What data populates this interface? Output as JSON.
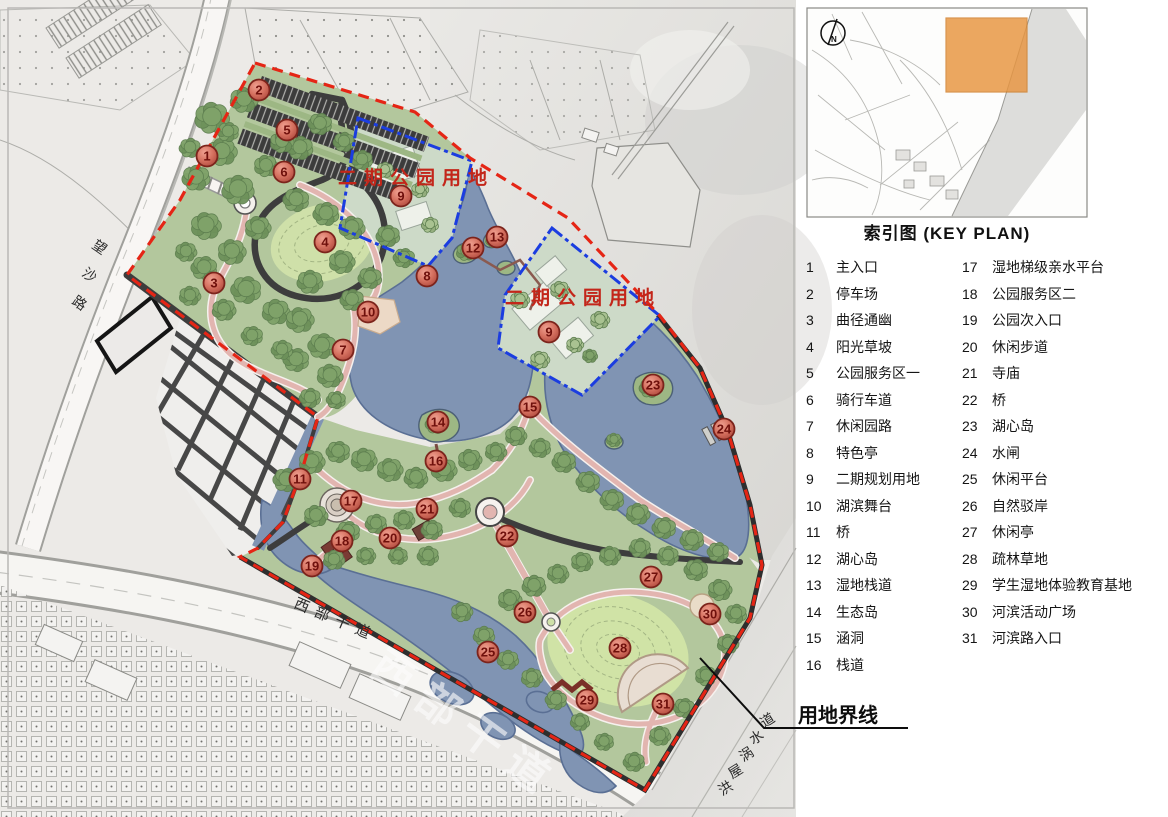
{
  "colors": {
    "boundary_red": "#e52515",
    "phase_blue": "#1b3de0",
    "marker_ring": "#7c241c",
    "marker_text": "#6f100c",
    "keyplan_highlight": "#e8953f",
    "lake": "#8094b3",
    "park_green": "#b3c79d"
  },
  "map": {
    "markers": [
      {
        "n": "1",
        "x": 207,
        "y": 156
      },
      {
        "n": "2",
        "x": 259,
        "y": 90
      },
      {
        "n": "3",
        "x": 214,
        "y": 283
      },
      {
        "n": "4",
        "x": 325,
        "y": 242
      },
      {
        "n": "5",
        "x": 287,
        "y": 130
      },
      {
        "n": "6",
        "x": 284,
        "y": 172
      },
      {
        "n": "7",
        "x": 343,
        "y": 350
      },
      {
        "n": "8",
        "x": 427,
        "y": 276
      },
      {
        "n": "9",
        "x": 401,
        "y": 196
      },
      {
        "n": "9",
        "x": 549,
        "y": 332
      },
      {
        "n": "10",
        "x": 368,
        "y": 312
      },
      {
        "n": "11",
        "x": 300,
        "y": 479
      },
      {
        "n": "12",
        "x": 473,
        "y": 248
      },
      {
        "n": "13",
        "x": 497,
        "y": 237
      },
      {
        "n": "14",
        "x": 438,
        "y": 422
      },
      {
        "n": "15",
        "x": 530,
        "y": 407
      },
      {
        "n": "16",
        "x": 436,
        "y": 461
      },
      {
        "n": "17",
        "x": 351,
        "y": 501
      },
      {
        "n": "18",
        "x": 342,
        "y": 541
      },
      {
        "n": "19",
        "x": 312,
        "y": 566
      },
      {
        "n": "20",
        "x": 390,
        "y": 538
      },
      {
        "n": "21",
        "x": 427,
        "y": 509
      },
      {
        "n": "22",
        "x": 507,
        "y": 536
      },
      {
        "n": "23",
        "x": 653,
        "y": 385
      },
      {
        "n": "24",
        "x": 724,
        "y": 429
      },
      {
        "n": "25",
        "x": 488,
        "y": 652
      },
      {
        "n": "26",
        "x": 525,
        "y": 612
      },
      {
        "n": "27",
        "x": 651,
        "y": 577
      },
      {
        "n": "28",
        "x": 620,
        "y": 648
      },
      {
        "n": "29",
        "x": 587,
        "y": 700
      },
      {
        "n": "30",
        "x": 710,
        "y": 614
      },
      {
        "n": "31",
        "x": 663,
        "y": 704
      }
    ],
    "area_labels": [
      {
        "text": "二期公园用地",
        "x": 338,
        "y": 184,
        "size": 19,
        "ls": 7
      },
      {
        "text": "二期公园用地",
        "x": 505,
        "y": 304,
        "size": 19,
        "ls": 7
      }
    ],
    "road_labels": [
      {
        "text": "望沙路",
        "char_x": [
          91,
          81,
          71
        ],
        "char_y": [
          247,
          275,
          303
        ],
        "rotate": 35,
        "size": 14,
        "style": "dark"
      },
      {
        "text": "西部干道",
        "x": 293,
        "y": 607,
        "rotate": 23,
        "size": 15,
        "ls": 7,
        "style": "dark"
      },
      {
        "text": "西部干道",
        "x": 368,
        "y": 672,
        "rotate": 36,
        "size": 42,
        "ls": 13,
        "style": "watermark"
      },
      {
        "text": "洪屋涡水道",
        "char_x": [
          722,
          732,
          743,
          753,
          764
        ],
        "char_y": [
          796,
          779,
          762,
          745,
          728
        ],
        "rotate": -32,
        "size": 14,
        "style": "dark"
      }
    ],
    "boundary_label": {
      "text": "用地界线"
    }
  },
  "key_plan": {
    "caption": "索引图 (KEY  PLAN)",
    "north_label": "N"
  },
  "legend": {
    "col1": [
      {
        "num": "1",
        "label": "主入口"
      },
      {
        "num": "2",
        "label": "停车场"
      },
      {
        "num": "3",
        "label": "曲径通幽"
      },
      {
        "num": "4",
        "label": "阳光草坡"
      },
      {
        "num": "5",
        "label": "公园服务区一"
      },
      {
        "num": "6",
        "label": "骑行车道"
      },
      {
        "num": "7",
        "label": "休闲园路"
      },
      {
        "num": "8",
        "label": "特色亭"
      },
      {
        "num": "9",
        "label": "二期规划用地"
      },
      {
        "num": "10",
        "label": "湖滨舞台"
      },
      {
        "num": "11",
        "label": "桥"
      },
      {
        "num": "12",
        "label": "湖心岛"
      },
      {
        "num": "13",
        "label": "湿地栈道"
      },
      {
        "num": "14",
        "label": "生态岛"
      },
      {
        "num": "15",
        "label": "涵洞"
      },
      {
        "num": "16",
        "label": "栈道"
      }
    ],
    "col2": [
      {
        "num": "17",
        "label": "湿地梯级亲水平台"
      },
      {
        "num": "18",
        "label": "公园服务区二"
      },
      {
        "num": "19",
        "label": "公园次入口"
      },
      {
        "num": "20",
        "label": "休闲步道"
      },
      {
        "num": "21",
        "label": "寺庙"
      },
      {
        "num": "22",
        "label": "桥"
      },
      {
        "num": "23",
        "label": "湖心岛"
      },
      {
        "num": "24",
        "label": "水闸"
      },
      {
        "num": "25",
        "label": "休闲平台"
      },
      {
        "num": "26",
        "label": "自然驳岸"
      },
      {
        "num": "27",
        "label": "休闲亭"
      },
      {
        "num": "28",
        "label": "疏林草地"
      },
      {
        "num": "29",
        "label": "学生湿地体验教育基地"
      },
      {
        "num": "30",
        "label": "河滨活动广场"
      },
      {
        "num": "31",
        "label": "河滨路入口"
      }
    ]
  }
}
